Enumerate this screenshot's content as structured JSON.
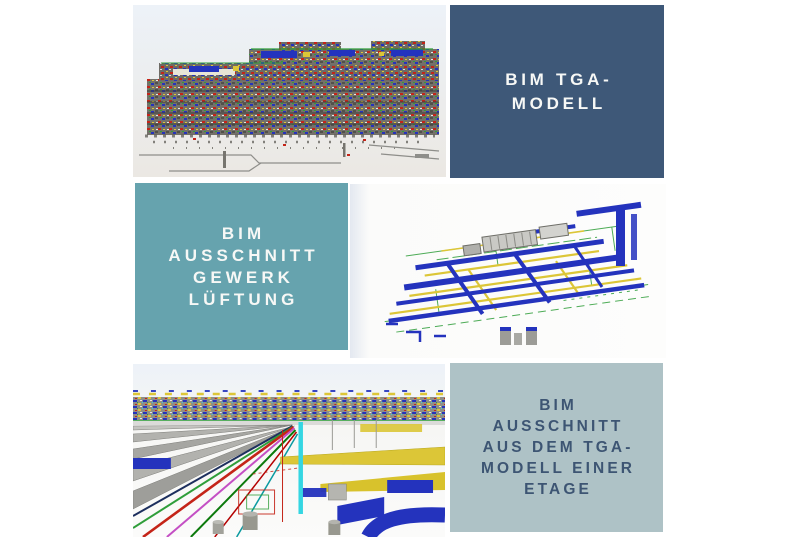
{
  "colors": {
    "page_bg": "#ffffff",
    "box_dark_blue": "#3e5878",
    "box_teal": "#66a3ae",
    "box_pale_teal": "#aec2c6",
    "label_light_text": "#f7f8f6",
    "label_dark_text": "#3d5573",
    "mep_blue": "#2433bd",
    "mep_yellow": "#dcc637",
    "mep_red": "#c42418",
    "mep_green": "#2f9e3a",
    "mep_cyan": "#35d6e2",
    "mep_magenta": "#c44fc4",
    "mep_gray": "#a3a39e",
    "mep_dark_gray": "#53514b",
    "model_sky": "#edf2f8",
    "model_ground": "#ebe8e3"
  },
  "labels": [
    {
      "id": "bim-tga-modell",
      "text": "BIM TGA-MODELL",
      "lines": [
        "BIM TGA-",
        "MODELL"
      ]
    },
    {
      "id": "bim-ausschnitt-gewerk-lueftung",
      "text": "BIM AUSSCHNITT GEWERK LÜFTUNG",
      "lines": [
        "BIM",
        "AUSSCHNITT",
        "GEWERK",
        "LÜFTUNG"
      ]
    },
    {
      "id": "bim-ausschnitt-etage",
      "text": "BIM AUSSCHNITT AUS DEM TGA-MODELL EINER ETAGE",
      "lines": [
        "BIM",
        "AUSSCHNITT",
        "AUS DEM TGA-",
        "MODELL EINER",
        "ETAGE"
      ]
    }
  ],
  "images": [
    {
      "id": "tga-model-overview-render"
    },
    {
      "id": "lueftung-gewerk-model-render"
    },
    {
      "id": "etage-model-perspective-render"
    }
  ]
}
